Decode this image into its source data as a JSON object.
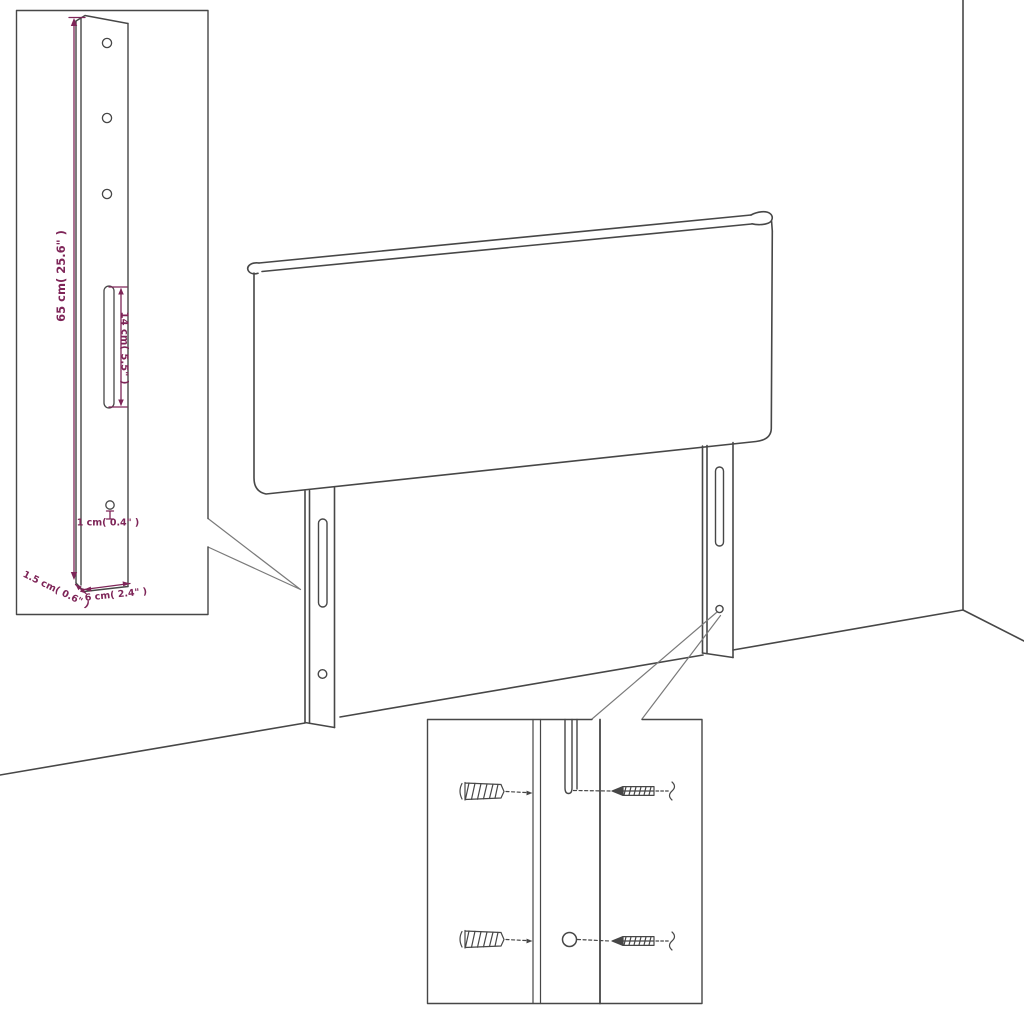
{
  "figure": {
    "type": "product-assembly-diagram",
    "subject": "upholstered headboard with two mounting legs, shown against a room corner",
    "insets": {
      "top_left": "enlarged side view of a mounting leg with dimension callouts",
      "bottom_center": "enlarged detail of leg slot and hole with wall plugs and screws"
    }
  },
  "dimensions": {
    "leg_height": "65 cm( 25.6\" )",
    "slot_length": "14 cm( 5.5\" )",
    "hole_diameter": "1 cm( 0.4\" )",
    "leg_depth": "1.5 cm( 0.6\" )",
    "leg_width": "6 cm( 2.4\" )"
  },
  "colors": {
    "background": "#ffffff",
    "line_art": "#474747",
    "leader_lines": "#7a7a7a",
    "dimension_accent": "#7e2558"
  }
}
